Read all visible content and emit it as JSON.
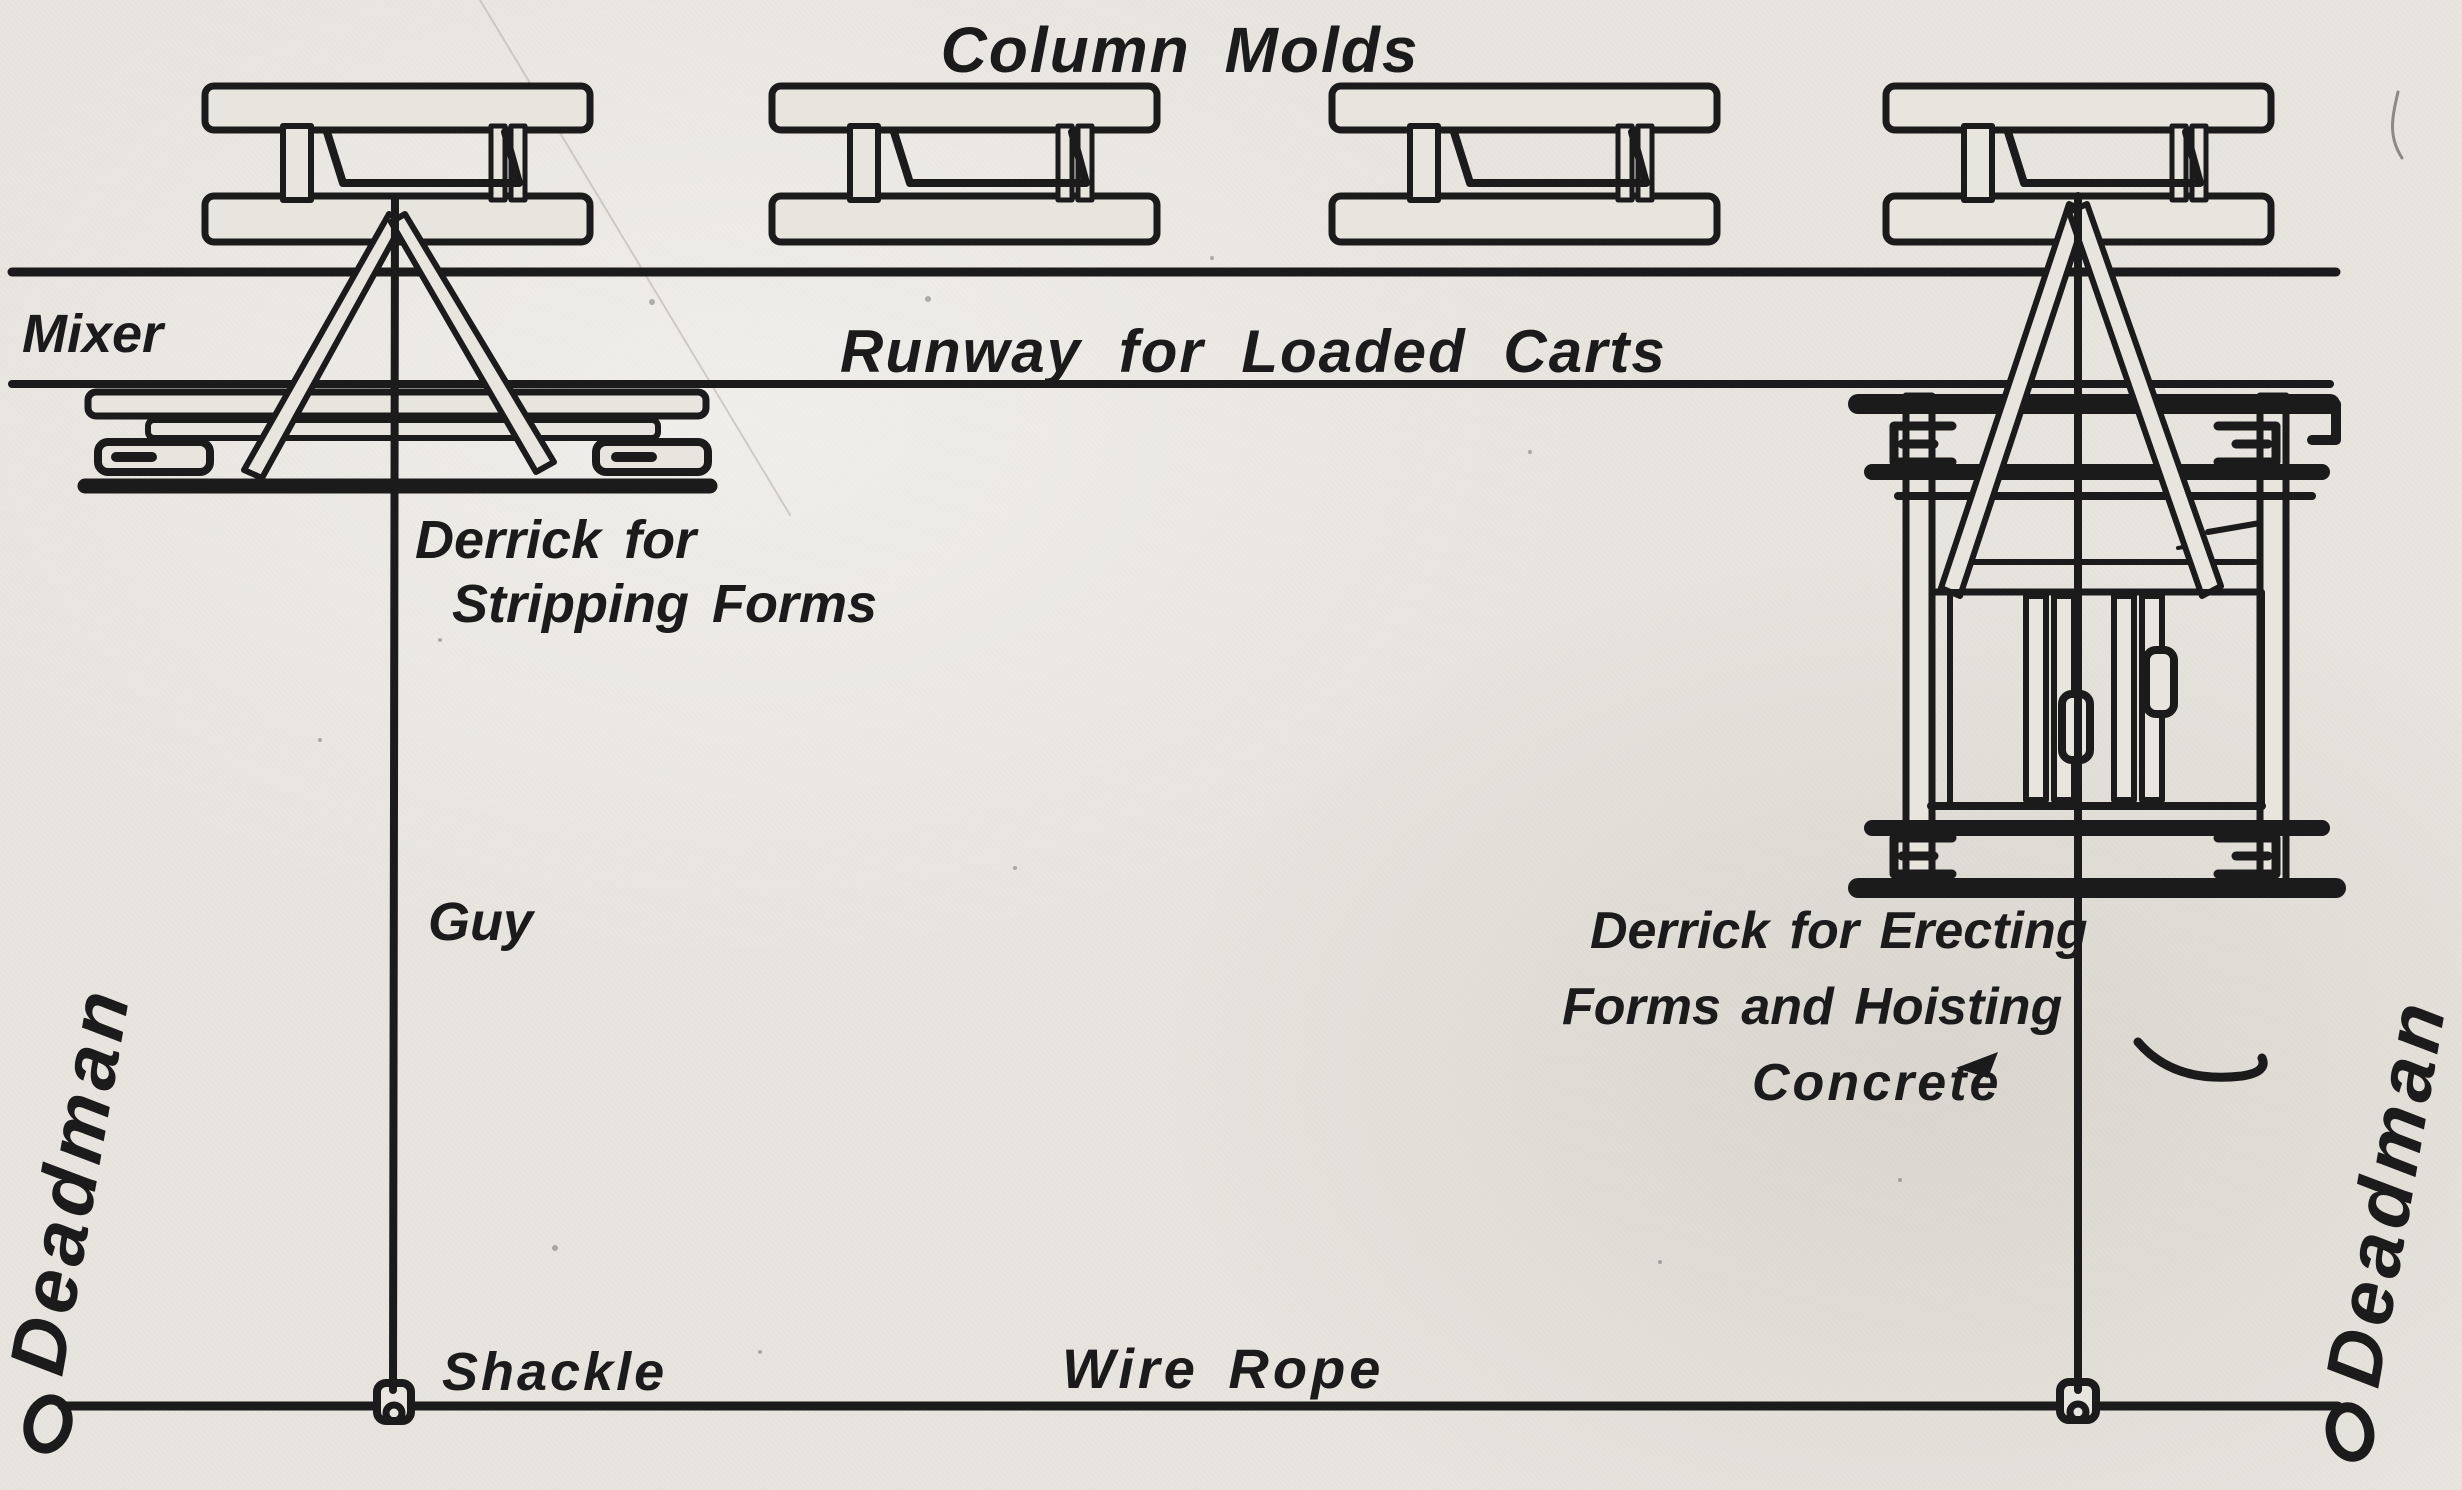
{
  "diagram": {
    "title": "Column Molds",
    "labels": {
      "mixer": "Mixer",
      "runway": "Runway for Loaded Carts",
      "stripping_derrick": {
        "line1": "Derrick for",
        "line2": "Stripping Forms"
      },
      "guy": "Guy",
      "shackle": "Shackle",
      "wire_rope": "Wire Rope",
      "erecting_derrick": {
        "line1": "Derrick for Erecting",
        "line2": "Forms and Hoisting",
        "line3": "Concrete"
      },
      "deadman_left": "Deadman",
      "deadman_right": "Deadman"
    },
    "colors": {
      "paper": "#e8e5df",
      "ink": "#1b1b1b"
    }
  }
}
